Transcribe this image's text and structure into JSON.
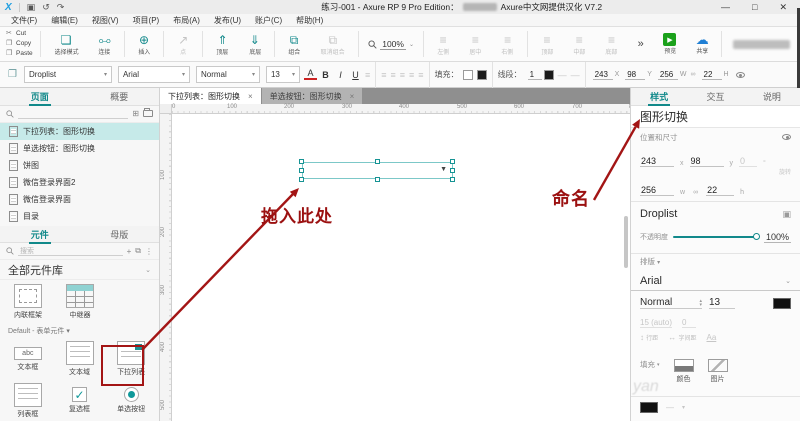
{
  "titlebar": {
    "logo": "X",
    "save": "▣",
    "undo": "↺",
    "redo": "↷",
    "title_left": "练习-001 - Axure RP 9 Pro Edition：",
    "title_right": "Axure中文网提供汉化 V7.2",
    "window": {
      "minimize": "—",
      "maximize": "□",
      "close": "✕"
    }
  },
  "menus": [
    {
      "label": "文件(F)"
    },
    {
      "label": "编辑(E)"
    },
    {
      "label": "视图(V)"
    },
    {
      "label": "项目(P)"
    },
    {
      "label": "布局(A)"
    },
    {
      "label": "发布(U)"
    },
    {
      "label": "账户(C)"
    },
    {
      "label": "帮助(H)"
    }
  ],
  "icons": {
    "caret": "▾",
    "chev_down": "⌄",
    "chev_up": "▴",
    "close": "×",
    "dropdown": "▼",
    "add_box": "⊞",
    "plus": "+",
    "dots": "⋮",
    "stack": "⧉",
    "degree": "°",
    "cut": "✂",
    "doc": "❐",
    "paste": "❒",
    "select": "❏",
    "connect": "⧟",
    "insert": "⊕",
    "point": "↗",
    "front": "⇑",
    "back": "⇓",
    "group": "⧉",
    "ungroup": "⧉",
    "align": "≡",
    "play": "▶",
    "cloud": "☁",
    "link": "∞",
    "style_edit": "▣",
    "lh": "↕",
    "ls": "↔",
    "case_a": "Aa",
    "dash": "—"
  },
  "toolbar": {
    "clipboard": [
      {
        "label": "Cut"
      },
      {
        "label": "Copy"
      },
      {
        "label": "Paste"
      }
    ],
    "select_mode": "选择模式",
    "connect": "连接",
    "insert": "插入",
    "point": "点",
    "front": "顶层",
    "back": "底层",
    "group": "组合",
    "ungroup": "取消组合",
    "zoom_value": "100%",
    "align_left": "左侧",
    "align_center": "居中",
    "align_right": "右侧",
    "align_top": "顶部",
    "align_middle": "中部",
    "align_bottom": "底部",
    "more": "»",
    "preview": "预览",
    "share": "共享"
  },
  "formatbar": {
    "style": "Droplist",
    "font": "Arial",
    "weight": "Normal",
    "size": "13",
    "color_btn": "A",
    "bold": "B",
    "italic": "I",
    "underline": "U",
    "fill_label": "填充：",
    "line_label": "线段：",
    "line_weight": "1",
    "x": "243",
    "x_label": "X",
    "y": "98",
    "y_label": "Y",
    "w": "256",
    "w_label": "W",
    "h": "22",
    "h_label": "H"
  },
  "left_panel": {
    "pages_tab": "页面",
    "outline_tab": "概要",
    "pages": [
      {
        "label": "下拉列表：图形切换"
      },
      {
        "label": "单选按钮：图形切换"
      },
      {
        "label": "饼图"
      },
      {
        "label": "微信登录界面2"
      },
      {
        "label": "微信登录界面"
      },
      {
        "label": "目录"
      }
    ],
    "widgets_tab": "元件",
    "masters_tab": "母版",
    "search_placeholder": "搜索",
    "library_header": "全部元件库",
    "library_items": [
      {
        "label": "内联框架"
      },
      {
        "label": "中继器"
      }
    ],
    "section_header": "Default - 表单元件",
    "form_widgets": [
      {
        "label": "文本框",
        "sample": "abc"
      },
      {
        "label": "文本域"
      },
      {
        "label": "下拉列表"
      },
      {
        "label": "列表框"
      },
      {
        "label": "复选框",
        "glyph": "✓"
      },
      {
        "label": "单选按钮"
      }
    ]
  },
  "canvas": {
    "tabs": [
      {
        "label": "下拉列表：图形切换"
      },
      {
        "label": "单选按钮：图形切换"
      }
    ],
    "h_ruler": [
      "0",
      "100",
      "200",
      "300",
      "400",
      "500",
      "600",
      "700",
      "800"
    ],
    "v_ruler": [
      "100",
      "200",
      "300",
      "400",
      "500"
    ]
  },
  "right_panel": {
    "tabs": {
      "style": "样式",
      "interaction": "交互",
      "notes": "说明"
    },
    "widget_name": "图形切换",
    "position_section": "位置和尺寸",
    "x": "243",
    "x_label": "x",
    "y": "98",
    "y_label": "y",
    "rotation": "0",
    "rotation_label": "旋转",
    "w": "256",
    "w_label": "w",
    "h": "22",
    "h_label": "h",
    "style_name": "Droplist",
    "opacity_label": "不透明度",
    "opacity_value": "100%",
    "typography_label": "排版",
    "font": "Arial",
    "weight": "Normal",
    "size": "13",
    "line_height_value": "15 (auto)",
    "letter_spacing_value": "0",
    "line_height_label": "行距",
    "letter_spacing_label": "字间距",
    "fill_label": "填充",
    "color_button": "颜色",
    "image_button": "图片"
  },
  "annotations": {
    "drag_here": "拖入此处",
    "naming": "命名"
  },
  "watermark": "yan",
  "colors": {
    "accent_teal": "#12898b",
    "annotation_red": "#a31515",
    "selection_fill": "#c6eae9"
  }
}
